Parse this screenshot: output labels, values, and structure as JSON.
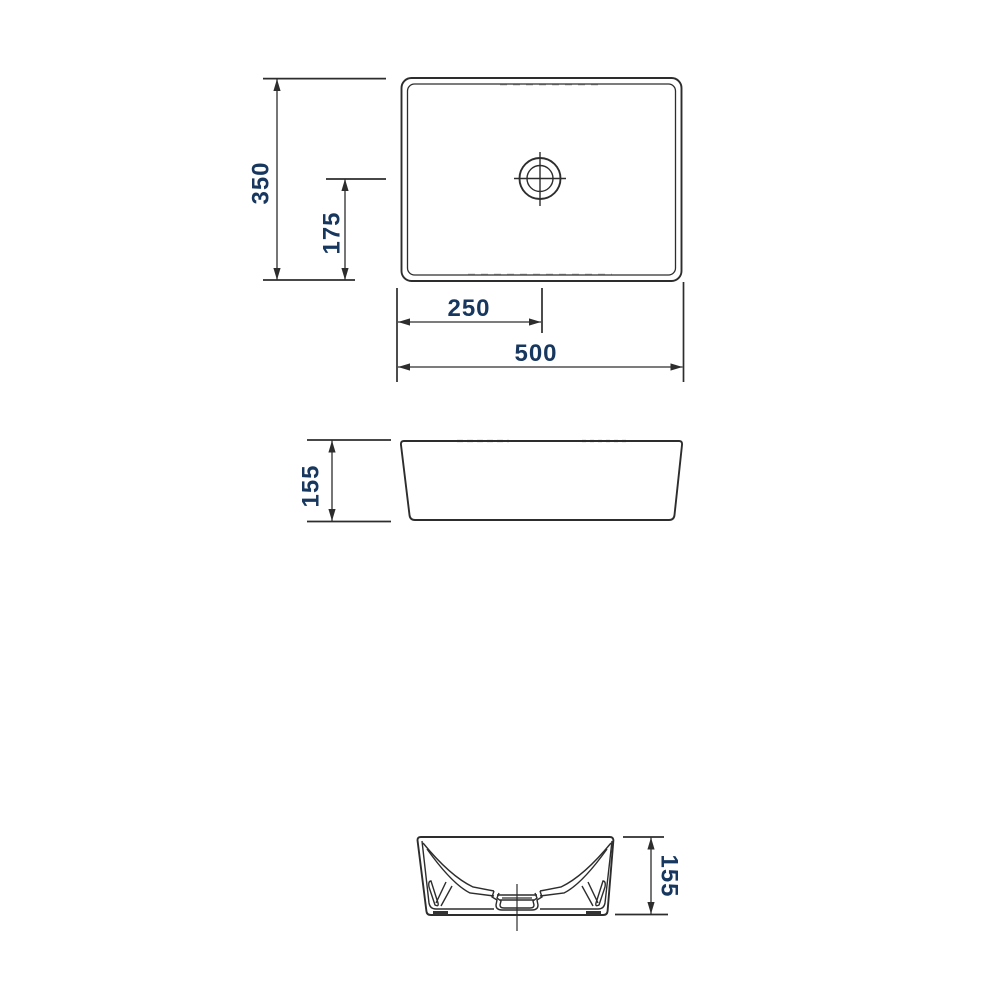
{
  "drawing": {
    "description": "Technical dimension drawing of a rectangular countertop washbasin, three orthographic views",
    "colors": {
      "outline": "#2d2d2d",
      "dimension_line": "#3a3a3a",
      "dimension_text": "#17375e",
      "background": "#ffffff"
    },
    "views": {
      "top": {
        "name": "top view (plan)",
        "dims": {
          "overall_width": "500",
          "overall_depth": "350",
          "drain_offset_from_left": "250",
          "drain_offset_from_front": "175"
        }
      },
      "front": {
        "name": "front view",
        "dims": {
          "height": "155"
        }
      },
      "side": {
        "name": "side section view",
        "dims": {
          "height": "155"
        }
      }
    }
  }
}
